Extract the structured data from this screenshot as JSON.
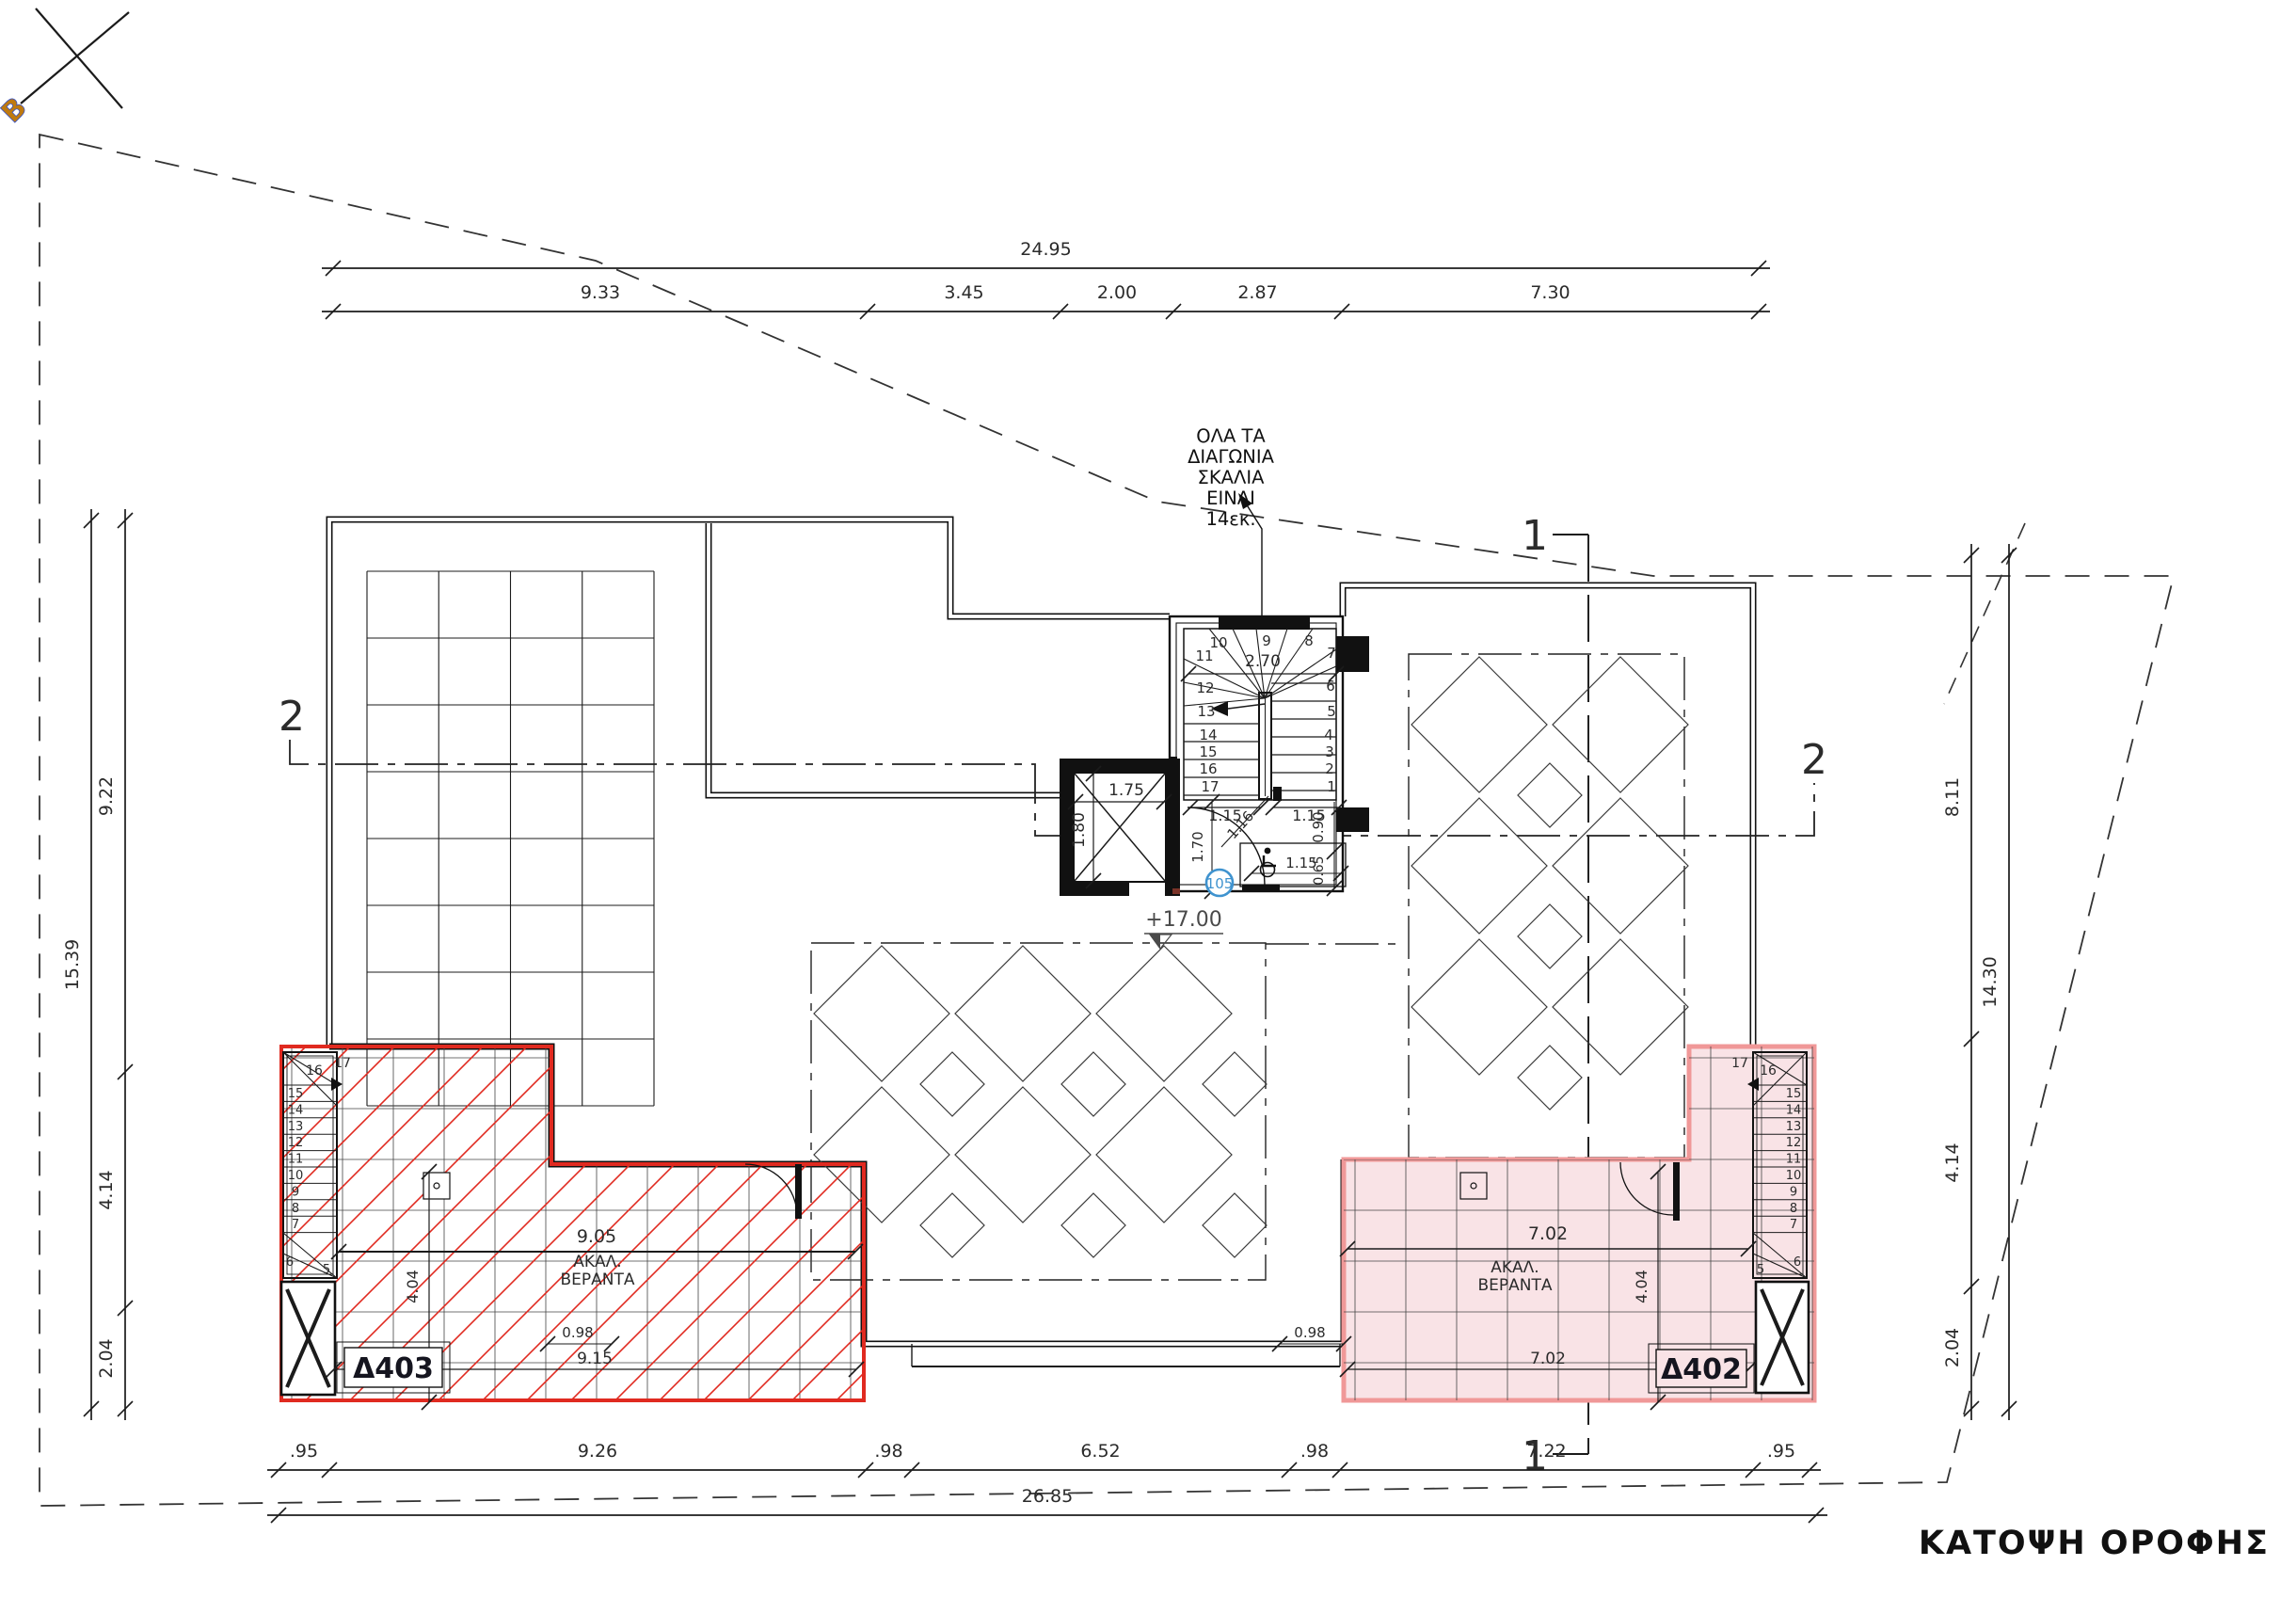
{
  "drawing_title": "ΚΑΤΟΨΗ ΟΡΟΦΗΣ",
  "north_symbol": {
    "label": "Β"
  },
  "stair_note": {
    "lines": [
      "ΟΛΑ ΤΑ",
      "ΔΙΑΓΩΝΙΑ",
      "ΣΚΑΛΙΑ",
      "ΕΙΝΑΙ",
      "14εκ."
    ]
  },
  "level_marker": {
    "value": "+17.00"
  },
  "room_tag": {
    "value": "105"
  },
  "section_markers": {
    "section_1": "1",
    "section_2": "2"
  },
  "perimeter_dimensions": {
    "top": {
      "total": "24.95",
      "segments": [
        "9.33",
        "3.45",
        "2.00",
        "2.87",
        "7.30"
      ]
    },
    "left": {
      "total": "15.39",
      "segments": [
        "9.22",
        "4.14",
        "2.04"
      ]
    },
    "right": {
      "total": "14.30",
      "segments": [
        "8.11",
        "4.14",
        "2.04"
      ]
    },
    "bottom": {
      "total": "26.85",
      "segments": [
        ".95",
        "9.26",
        ".98",
        "6.52",
        ".98",
        "7.22",
        ".95"
      ]
    }
  },
  "balcony_left": {
    "unit_tag": "Δ403",
    "use_lines": [
      "ΑΚΑΛ.",
      "ΒΕΡΑΝΤΑ"
    ],
    "dim_top": "9.05",
    "dim_bottom": "9.15",
    "dim_depth": "4.04",
    "stair_top_step": "17",
    "stair_steps": [
      "16",
      "15",
      "14",
      "13",
      "12",
      "11",
      "10",
      "9",
      "8",
      "7",
      "6",
      "5"
    ]
  },
  "balcony_right": {
    "unit_tag": "Δ402",
    "use_lines": [
      "ΑΚΑΛ.",
      "ΒΕΡΑΝΤΑ"
    ],
    "dim_top": "7.02",
    "dim_bottom": "7.02",
    "dim_depth": "4.04",
    "stair_top_step": "17",
    "stair_steps": [
      "16",
      "15",
      "14",
      "13",
      "12",
      "11",
      "10",
      "9",
      "8",
      "7",
      "6",
      "5"
    ]
  },
  "parapet_gaps": [
    "0.98",
    "0.98"
  ],
  "main_stair": {
    "steps_left": [
      "10",
      "11",
      "12",
      "13",
      "14",
      "15",
      "16",
      "17"
    ],
    "steps_right": [
      "9",
      "8",
      "7",
      "6",
      "5",
      "4",
      "3",
      "2",
      "1"
    ],
    "dim_width": "2.70",
    "dim_left_run": "1.15",
    "dim_right_run": "1.15",
    "dim_landing": "1.15",
    "dim_diag": "1.16",
    "dim_left_depth": "1.70",
    "dim_right_upper": "0.90",
    "dim_right_lower": "0.65"
  },
  "elevator": {
    "dim_width": "1.75",
    "dim_depth": "1.80"
  },
  "colors": {
    "ink": "#1b1b1b",
    "dim_text": "#2b2b2b",
    "red_hatch": "#e02a20",
    "balcony_left_outline": "#e02a20",
    "balcony_right_outline": "#f09898",
    "balcony_right_fill": "#f9e3e6",
    "accent_blue": "#3f93cf",
    "level_text": "#4a4a4a"
  }
}
